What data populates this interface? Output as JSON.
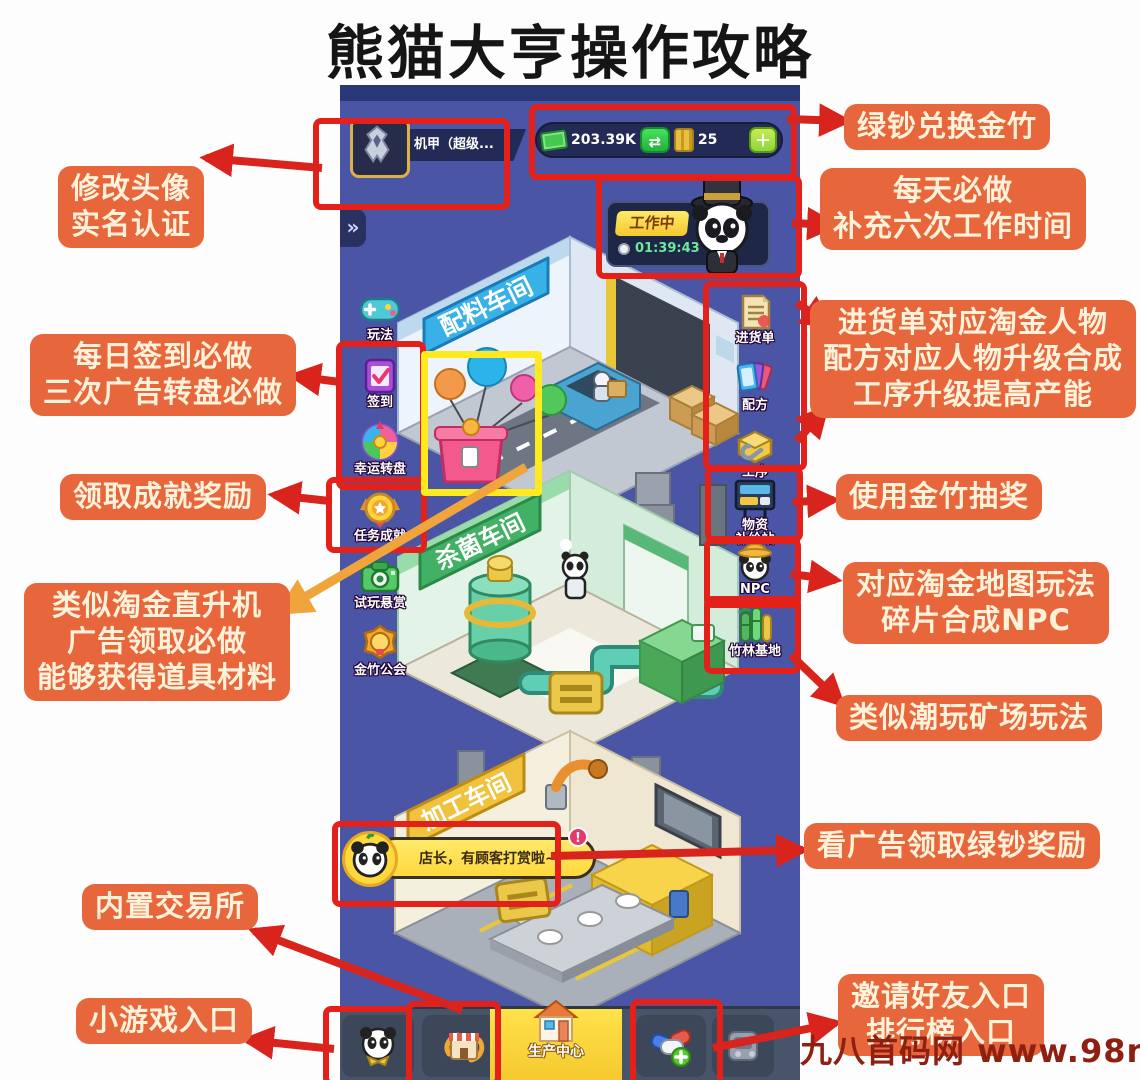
{
  "title": "熊猫大亨操作攻略",
  "watermark": "九八首码网 www.98ni.com",
  "colors": {
    "annotation_bg": "#e8663c",
    "highlight_red": "#e3211a",
    "highlight_yellow": "#ffe920",
    "arrow_red": "#d8241c",
    "arrow_orange": "#f0a43c",
    "game_bg": "#4a55a5"
  },
  "game": {
    "expand_symbol": "»",
    "player": {
      "name": "机甲（超级...",
      "cash": "203.39K",
      "bamboo": "25"
    },
    "symbols": {
      "swap": "⇄",
      "plus": "＋"
    },
    "working": {
      "status": "工作中",
      "timer": "01:39:43"
    },
    "left_menu": [
      {
        "label": "玩法"
      },
      {
        "label": "签到"
      },
      {
        "label": "幸运转盘"
      },
      {
        "label": "任务成就"
      },
      {
        "label": "试玩悬赏"
      },
      {
        "label": "金竹公会"
      }
    ],
    "right_menu": [
      {
        "label": "进货单"
      },
      {
        "label": "配方"
      },
      {
        "label": "工序"
      },
      {
        "line1": "物资",
        "line2": "补给站"
      },
      {
        "label": "NPC"
      },
      {
        "label": "竹林基地"
      }
    ],
    "floors": [
      {
        "sign": "配料车间"
      },
      {
        "sign": "杀菌车间"
      },
      {
        "sign": "加工车间"
      }
    ],
    "bubble": {
      "text": "店长，有顾客打赏啦~",
      "alert": "!"
    },
    "nav": {
      "center_label": "生产中心"
    }
  },
  "annotations": {
    "modify": {
      "lines": [
        "修改头像",
        "实名认证"
      ]
    },
    "exchange": {
      "lines": [
        "绿钞兑换金竹"
      ]
    },
    "daily": {
      "lines": [
        "每天必做",
        "补充六次工作时间"
      ]
    },
    "signin": {
      "lines": [
        "每日签到必做",
        "三次广告转盘必做"
      ]
    },
    "achieve": {
      "lines": [
        "领取成就奖励"
      ]
    },
    "heli": {
      "lines": [
        "类似淘金直升机",
        "广告领取必做",
        "能够获得道具材料"
      ]
    },
    "workflow": {
      "lines": [
        "进货单对应淘金人物",
        "配方对应人物升级合成",
        "工序升级提高产能"
      ]
    },
    "lottery": {
      "lines": [
        "使用金竹抽奖"
      ]
    },
    "npcmap": {
      "lines": [
        "对应淘金地图玩法",
        "碎片合成NPC"
      ]
    },
    "mine": {
      "lines": [
        "类似潮玩矿场玩法"
      ]
    },
    "adreward": {
      "lines": [
        "看广告领取绿钞奖励"
      ]
    },
    "trade": {
      "lines": [
        "内置交易所"
      ]
    },
    "minigame": {
      "lines": [
        "小游戏入口"
      ]
    },
    "invite": {
      "lines": [
        "邀请好友入口",
        "排行榜入口"
      ]
    }
  }
}
